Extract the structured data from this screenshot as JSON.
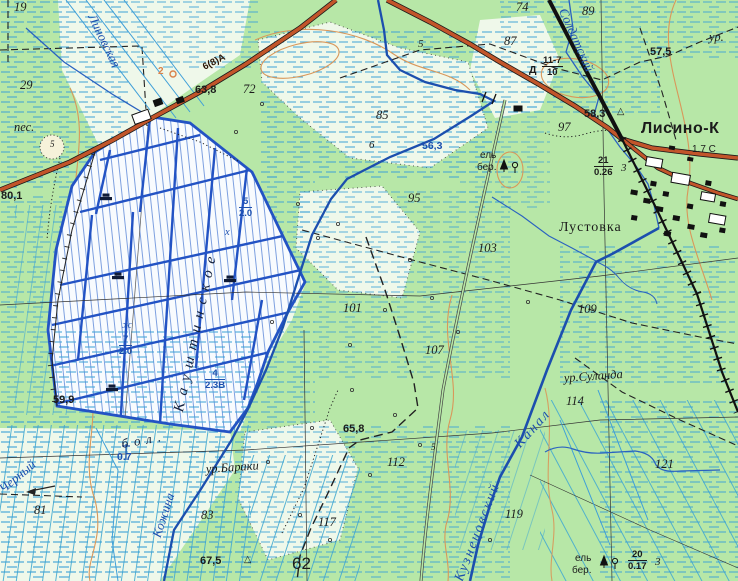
{
  "map_type": "soviet-topographic-map",
  "colors": {
    "land": "#b7e7a7",
    "bog_white": "#f8fbfe",
    "clearing_pale": "#eff8ea",
    "marsh_dash_blue": "#3aa0d6",
    "water_dark": "#1c4fae",
    "water_light": "#3f9fd8",
    "bog_grid_blue": "#2353c4",
    "road_fill": "#c2552a",
    "railway_black": "#111111",
    "contour_orange": "#d9975a",
    "text_black": "#1b1b1b",
    "text_blue": "#1c4fae"
  },
  "settlements": {
    "town": "Лисино-К",
    "village": "Лустовка"
  },
  "hydrography": [
    "Черный",
    "Кожина",
    "Линовская",
    "Солдатский",
    "Кузнецовский Канал"
  ],
  "tracts": [
    "ур.Суланда",
    "ур.Бараки",
    "бол. Кауштинское"
  ],
  "labels": [
    {
      "n": "spot-19",
      "t": "19",
      "x": 14,
      "y": 0,
      "c": "it"
    },
    {
      "n": "spot-29",
      "t": "29",
      "x": 20,
      "y": 78,
      "c": "it"
    },
    {
      "n": "sand-note",
      "t": "пес.",
      "x": 14,
      "y": 120,
      "c": "ur"
    },
    {
      "n": "sand-pit-number",
      "t": "5",
      "x": 50,
      "y": 139,
      "c": "tiny"
    },
    {
      "n": "spring-number",
      "t": "2",
      "x": 158,
      "y": 66,
      "c": "or"
    },
    {
      "n": "height-63-8",
      "t": "63,8",
      "x": 195,
      "y": 84,
      "c": "ht"
    },
    {
      "n": "spot-72",
      "t": "72",
      "x": 243,
      "y": 82,
      "c": "it"
    },
    {
      "n": "road-grade-note",
      "t": "6(8)А",
      "x": 204,
      "y": 62,
      "c": "road",
      "r": -27
    },
    {
      "n": "spot-85",
      "t": "85",
      "x": 376,
      "y": 108,
      "c": "it"
    },
    {
      "n": "spot-74",
      "t": "74",
      "x": 516,
      "y": 0,
      "c": "it"
    },
    {
      "n": "spot-87",
      "t": "87",
      "x": 504,
      "y": 34,
      "c": "it"
    },
    {
      "n": "spot-89",
      "t": "89",
      "x": 582,
      "y": 4,
      "c": "it"
    },
    {
      "n": "height-57-5",
      "t": "57,5",
      "x": 650,
      "y": 46,
      "c": "ht"
    },
    {
      "n": "tract-clipped",
      "t": "ур.",
      "x": 709,
      "y": 30,
      "c": "ur2"
    },
    {
      "n": "height-58-3",
      "t": "58,3",
      "x": 584,
      "y": 108,
      "c": "ht"
    },
    {
      "n": "geodetic-triangle-1",
      "t": "△",
      "x": 617,
      "y": 106,
      "c": "tri"
    },
    {
      "n": "spot-97",
      "t": "97",
      "x": 558,
      "y": 120,
      "c": "it"
    },
    {
      "n": "bridge-material",
      "t": "Д",
      "x": 529,
      "y": 64,
      "c": "ht2"
    },
    {
      "n": "bridge-spec",
      "frac": {
        "num": "11-7",
        "den": "10"
      },
      "x": 542,
      "y": 55,
      "c": "frac"
    },
    {
      "n": "ride-number-5",
      "t": "5",
      "x": 418,
      "y": 38,
      "c": "it2"
    },
    {
      "n": "ride-number-6",
      "t": "6",
      "x": 369,
      "y": 139,
      "c": "it2"
    },
    {
      "n": "water-level-56-3",
      "t": "56,3",
      "x": 422,
      "y": 140,
      "c": "bl2"
    },
    {
      "n": "forest-stand-1-species-a",
      "t": "ель",
      "x": 480,
      "y": 150,
      "c": "els"
    },
    {
      "n": "forest-stand-1-species-b",
      "t": "бер.",
      "x": 477,
      "y": 162,
      "c": "els"
    },
    {
      "n": "forest-stand-1-metrics",
      "frac": {
        "num": "21",
        "den": "0.26"
      },
      "x": 594,
      "y": 155,
      "c": "frac"
    },
    {
      "n": "forest-stand-1-spacing",
      "t": "3",
      "x": 621,
      "y": 162,
      "c": "it2"
    },
    {
      "n": "spot-95",
      "t": "95",
      "x": 408,
      "y": 191,
      "c": "it"
    },
    {
      "n": "spot-103",
      "t": "103",
      "x": 478,
      "y": 241,
      "c": "it"
    },
    {
      "n": "spot-101",
      "t": "101",
      "x": 343,
      "y": 301,
      "c": "it"
    },
    {
      "n": "spot-107",
      "t": "107",
      "x": 425,
      "y": 343,
      "c": "it"
    },
    {
      "n": "spot-109",
      "t": "109",
      "x": 578,
      "y": 302,
      "c": "it"
    },
    {
      "n": "town-name",
      "t": "Лисино-К",
      "x": 641,
      "y": 120,
      "c": "town"
    },
    {
      "n": "road-distance-note",
      "t": "1.7 С",
      "x": 692,
      "y": 144,
      "c": "note"
    },
    {
      "n": "village-name",
      "t": "Лустовка",
      "x": 559,
      "y": 220,
      "c": "vill"
    },
    {
      "n": "tract-sulanda",
      "t": "ур.Суланда",
      "x": 564,
      "y": 371,
      "c": "ur",
      "r": -4
    },
    {
      "n": "spot-114",
      "t": "114",
      "x": 566,
      "y": 394,
      "c": "it"
    },
    {
      "n": "bog-name-prefix",
      "t": "бол.",
      "x": 122,
      "y": 436,
      "c": "bog",
      "s": 6,
      "r": -10
    },
    {
      "n": "bog-name",
      "t": "Кауштинское",
      "x": 181,
      "y": 402,
      "c": "bogbig",
      "s": 7,
      "r": -78
    },
    {
      "n": "peat-depth-1",
      "frac": {
        "num": "5",
        "den": "2.0"
      },
      "x": 239,
      "y": 196,
      "c": "frac fracbl"
    },
    {
      "n": "peat-symbol-1",
      "t": "х",
      "x": 225,
      "y": 227,
      "c": "bl"
    },
    {
      "n": "peat-depth-2",
      "frac": {
        "num": "7",
        "den": "2.0"
      },
      "x": 119,
      "y": 334,
      "c": "frac fracbl"
    },
    {
      "n": "peat-symbol-2",
      "t": "ж",
      "x": 122,
      "y": 320,
      "c": "bl"
    },
    {
      "n": "peat-depth-3",
      "frac": {
        "num": "4",
        "den": "2.3В"
      },
      "x": 205,
      "y": 368,
      "c": "frac fracbl"
    },
    {
      "n": "marsh-depth-value",
      "t": "0.7",
      "x": 117,
      "y": 451,
      "c": "bl2"
    },
    {
      "n": "river-name-chernyy",
      "t": "Черный",
      "x": 2,
      "y": 482,
      "c": "blit",
      "r": -40
    },
    {
      "n": "river-name-kozhina",
      "t": "Кожина",
      "x": 158,
      "y": 528,
      "c": "blit",
      "r": -72
    },
    {
      "n": "river-name-linovskaya",
      "t": "Линовская",
      "x": 90,
      "y": 6,
      "c": "blit",
      "r": 64
    },
    {
      "n": "river-name-soldatskiy",
      "t": "Солдатский",
      "x": 561,
      "y": 0,
      "c": "blit",
      "r": 66
    },
    {
      "n": "canal-name-word1",
      "t": "Кузнецовский",
      "x": 461,
      "y": 572,
      "c": "blit2",
      "r": -69
    },
    {
      "n": "canal-name-word2",
      "t": "Канал",
      "x": 519,
      "y": 438,
      "c": "blit2",
      "r": -48
    },
    {
      "n": "tract-baraki",
      "t": "ур.Бараки",
      "x": 206,
      "y": 462,
      "c": "ur",
      "r": -4
    },
    {
      "n": "spot-83",
      "t": "83",
      "x": 201,
      "y": 508,
      "c": "it"
    },
    {
      "n": "spot-81",
      "t": "81",
      "x": 34,
      "y": 503,
      "c": "it"
    },
    {
      "n": "height-59-9",
      "t": "59,9",
      "x": 53,
      "y": 394,
      "c": "ht"
    },
    {
      "n": "height-80-1",
      "t": "80,1",
      "x": 1,
      "y": 190,
      "c": "ht"
    },
    {
      "n": "height-65-8",
      "t": "65,8",
      "x": 343,
      "y": 423,
      "c": "ht"
    },
    {
      "n": "spot-112",
      "t": "112",
      "x": 387,
      "y": 455,
      "c": "it"
    },
    {
      "n": "ride-number-5b",
      "t": "5",
      "x": 431,
      "y": 442,
      "c": "tiny"
    },
    {
      "n": "spot-119",
      "t": "119",
      "x": 505,
      "y": 507,
      "c": "it"
    },
    {
      "n": "spot-121",
      "t": "121",
      "x": 655,
      "y": 457,
      "c": "it"
    },
    {
      "n": "spot-117",
      "t": "117",
      "x": 318,
      "y": 515,
      "c": "it"
    },
    {
      "n": "quarter-62",
      "t": "62",
      "x": 292,
      "y": 554,
      "c": "big"
    },
    {
      "n": "height-67-5",
      "t": "67,5",
      "x": 200,
      "y": 555,
      "c": "ht"
    },
    {
      "n": "geodetic-triangle-2",
      "t": "△",
      "x": 244,
      "y": 554,
      "c": "tri"
    },
    {
      "n": "forest-stand-2-species-a",
      "t": "ель",
      "x": 575,
      "y": 553,
      "c": "els"
    },
    {
      "n": "forest-stand-2-species-b",
      "t": "бер.",
      "x": 572,
      "y": 565,
      "c": "els"
    },
    {
      "n": "forest-stand-2-metrics",
      "frac": {
        "num": "20",
        "den": "0.17"
      },
      "x": 628,
      "y": 549,
      "c": "frac"
    },
    {
      "n": "forest-stand-2-spacing",
      "t": "3",
      "x": 655,
      "y": 556,
      "c": "it2"
    }
  ]
}
